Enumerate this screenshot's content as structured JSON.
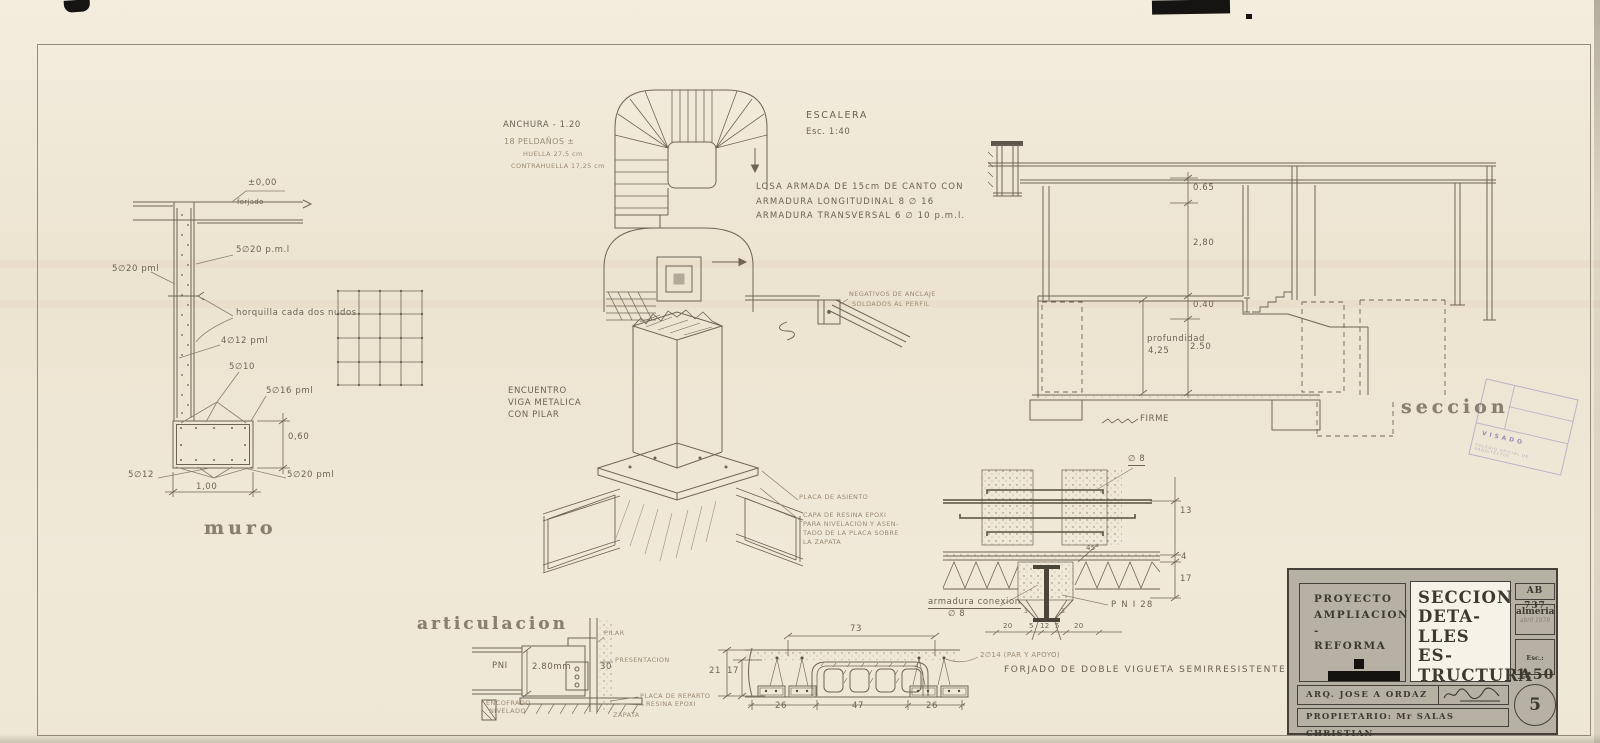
{
  "m": {
    "title": "muro",
    "elev": "±0,00",
    "forjado": "forjado",
    "r_top": "5∅20 p.m.l",
    "r_left": "5∅20 pml",
    "horquilla": "horquilla cada dos nudos",
    "r4": "4∅12 pml",
    "r5": "5∅10",
    "r6": "5∅16 pml",
    "d060": "0,60",
    "r7": "5∅12",
    "r8": "5∅20 pml",
    "d100": "1,00"
  },
  "e": {
    "title": "ESCALERA",
    "scale": "Esc. 1:40",
    "anchura": "ANCHURA - 1.20",
    "steps": "18 PELDAÑOS ±",
    "huella": "HUELLA 27,5 cm",
    "contrahuella": "CONTRAHUELLA 17,25 cm",
    "anchor1": "NEGATIVOS DE ANCLAJE",
    "anchor2": "SOLDADOS AL PERFIL"
  },
  "losa": {
    "l1": "LOSA ARMADA DE 15cm DE CANTO CON",
    "l2": "ARMADURA LONGITUDINAL 8 ∅ 16",
    "l3": "ARMADURA TRANSVERSAL 6 ∅ 10 p.m.l."
  },
  "enc": {
    "l1": "ENCUENTRO",
    "l2": "VIGA METALICA",
    "l3": "CON PILAR",
    "placa": "PLACA DE ASIENTO",
    "res1": "CAPA DE RESINA EPOXI",
    "res2": "PARA NIVELACION Y ASEN-",
    "res3": "TADO DE LA PLACA SOBRE",
    "res4": "LA ZAPATA"
  },
  "art": {
    "title": "articulacion",
    "pni": "PNI",
    "espesor": "2.80mm",
    "d30": "30",
    "pilar": "PILAR",
    "perforacion": "PRESENTACION",
    "encofrado1": "ENCOFRADO",
    "encofrado2": "NIVELADO",
    "placa": "PLACA DE REPARTO",
    "resina": "RESINA EPOXI",
    "zapata": "ZAPATA"
  },
  "sec": {
    "title": "seccion",
    "d065": "0.65",
    "d280": "2,80",
    "d040": "0.40",
    "profundidad": "profundidad",
    "d425": "4,25",
    "d250": "2.50",
    "firme": "FIRME"
  },
  "f": {
    "phi8": "∅ 8",
    "d13": "13",
    "d4": "4",
    "d17": "17",
    "a45": "45°",
    "arm1": "armadura conexion",
    "arm2": "∅ 8",
    "pni28": "P N I 28",
    "d20a": "20",
    "d5a": "5",
    "d12": "12",
    "d5b": "5",
    "d20b": "20",
    "d3a": "3",
    "d3b": "3",
    "caption": "FORJADO DE DOBLE VIGUETA SEMIRRESISTENTE"
  },
  "v": {
    "d73": "73",
    "d21": "21",
    "d17": "17",
    "d26a": "26",
    "d47": "47",
    "d26b": "26",
    "bars": "2∅14 (PAR Y APOYO)"
  },
  "tb": {
    "proy1": "PROYECTO",
    "proy2": "AMPLIACION -",
    "proy3": "REFORMA",
    "t1": "SECCION",
    "t2": "DETA-",
    "t3": "LLES ES-",
    "t4": "TRUCTURA",
    "code": "AB 737",
    "city": "almeria",
    "date": "abril 1978",
    "esc_k": "Esc.:",
    "esc_v": "1:50",
    "arq": "ARQ. JOSE A ORDAZ",
    "prop": "PROPIETARIO: Mr SALAS CHRISTIAN",
    "sheet": "5"
  },
  "stamp": {
    "visado": "VISADO",
    "sub": "COLEGIO OFICIAL DE ARQUITECTOS"
  },
  "colors": {
    "ink": "#6e6455",
    "paper": "#f0e9d8",
    "block_gray": "#b7b1a3",
    "stamp_purple": "#8076b6"
  }
}
